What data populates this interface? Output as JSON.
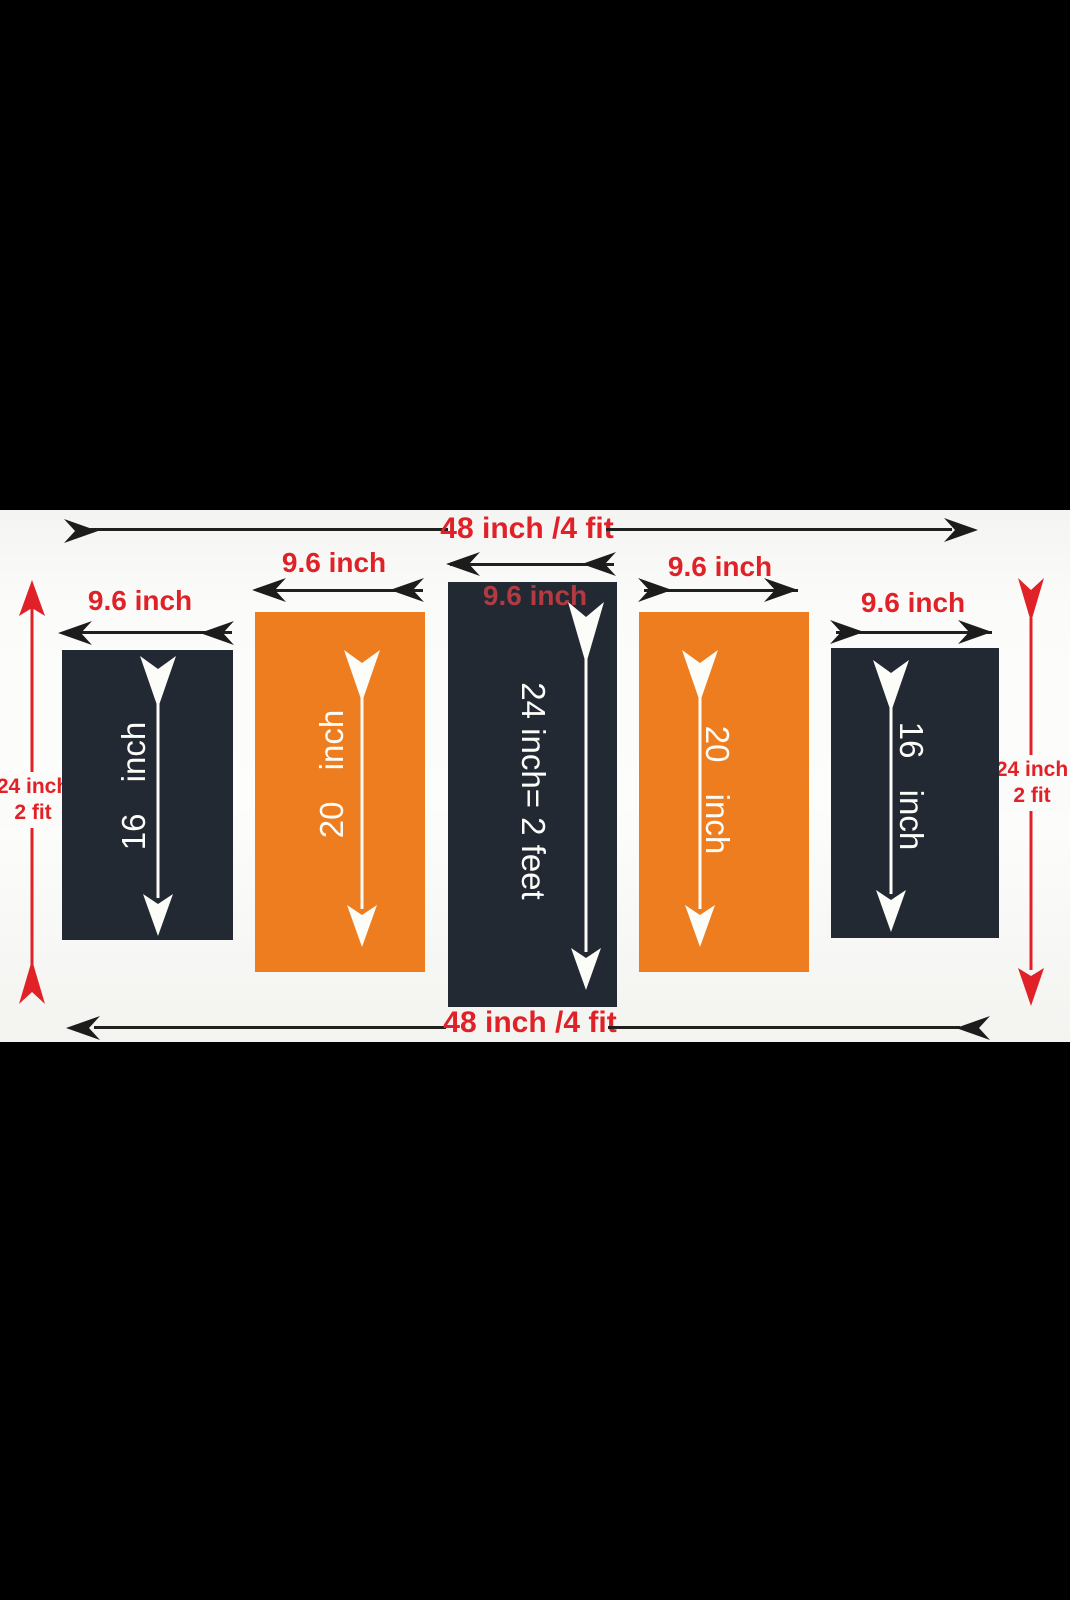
{
  "dimensions": {
    "top_width": "48 inch /4 fit",
    "bottom_width": "48 inch /4 fit",
    "left_height": {
      "line1": "24 inch",
      "line2": "2 fit"
    },
    "right_height": {
      "line1": "24 inch",
      "line2": "2 fit"
    }
  },
  "panels": [
    {
      "width_label": "9.6 inch",
      "height_label": "16 inch",
      "fill": "#232932"
    },
    {
      "width_label": "9.6 inch",
      "height_label": "20 inch",
      "fill": "#ee7d1f"
    },
    {
      "width_label": "9.6 inch",
      "height_label": "24 inch= 2 feet",
      "fill": "#232932"
    },
    {
      "width_label": "9.6 inch",
      "height_label": "20 inch",
      "fill": "#ee7d1f"
    },
    {
      "width_label": "9.6 inch",
      "height_label": "16 inch",
      "fill": "#232932"
    }
  ],
  "colors": {
    "background_band": "#000000",
    "canvas": "#fbfbf9",
    "dark_panel": "#232932",
    "orange_panel": "#ee7d1f",
    "red_accent": "#e02128",
    "muted_red_on_panel": "#b23a40",
    "dimension_line": "#202020",
    "panel_arrow": "#ffffff"
  }
}
